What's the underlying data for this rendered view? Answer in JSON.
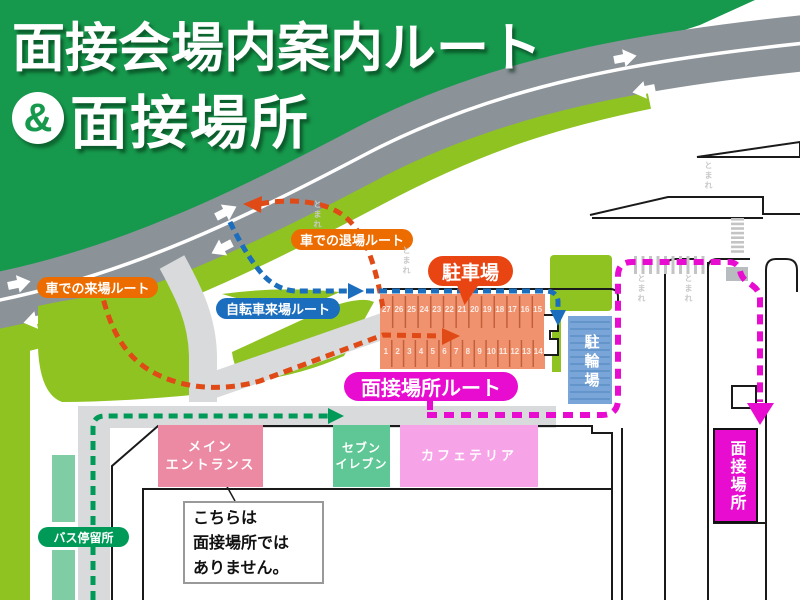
{
  "title": {
    "line1": "面接会場内案内ルート",
    "ampersand": "&",
    "line2": "面接場所"
  },
  "routes": {
    "car_exit": {
      "label": "車での退場ルート",
      "pill_color": "#ed6c00",
      "line_color": "#df4a16"
    },
    "car_arrival": {
      "label": "車での来場ルート",
      "pill_color": "#ed6c00",
      "line_color": "#df4a16"
    },
    "bicycle": {
      "label": "自転車来場ルート",
      "pill_color": "#1b6dbe",
      "line_color": "#1b6dbe"
    },
    "interview": {
      "label": "面接場所ルート",
      "pill_color": "#e80cd0",
      "line_color": "#e80cd0"
    },
    "bus": {
      "label": "バス停留所",
      "pill_color": "#009a58",
      "line_color": "#009a58"
    }
  },
  "places": {
    "parking_lot": {
      "label": "駐車場",
      "bubble_color": "#e84513",
      "area_color": "#f0926e"
    },
    "bike_parking": {
      "label": "駐輪場",
      "area_color": "#79a5d8"
    },
    "main_entrance": {
      "line1": "メイン",
      "line2": "エントランス",
      "color": "#ec8aa4"
    },
    "seven_eleven": {
      "line1": "セブン",
      "line2": "イレブン",
      "color": "#5ec795"
    },
    "cafeteria": {
      "label": "カフェテリア",
      "color": "#f6a3e8"
    },
    "interview_place": {
      "label": "面接場所",
      "color": "#e80cd0"
    }
  },
  "notice": {
    "line1": "こちらは",
    "line2": "面接場所では",
    "line3": "ありません。"
  },
  "road_markings": {
    "text": "とまれ"
  },
  "parking_numbers": {
    "top_row": [
      "27",
      "26",
      "25",
      "24",
      "23",
      "22",
      "21",
      "20",
      "19",
      "18",
      "17",
      "16",
      "15"
    ],
    "bottom_row": [
      "1",
      "2",
      "3",
      "4",
      "5",
      "6",
      "7",
      "8",
      "9",
      "10",
      "11",
      "12",
      "13",
      "14"
    ]
  },
  "base_colors": {
    "header_green": "#17994d",
    "lime": "#8fc322",
    "road_gray": "#8b9298",
    "walkway_gray": "#d9dadb",
    "mint": "#7fcda4"
  }
}
